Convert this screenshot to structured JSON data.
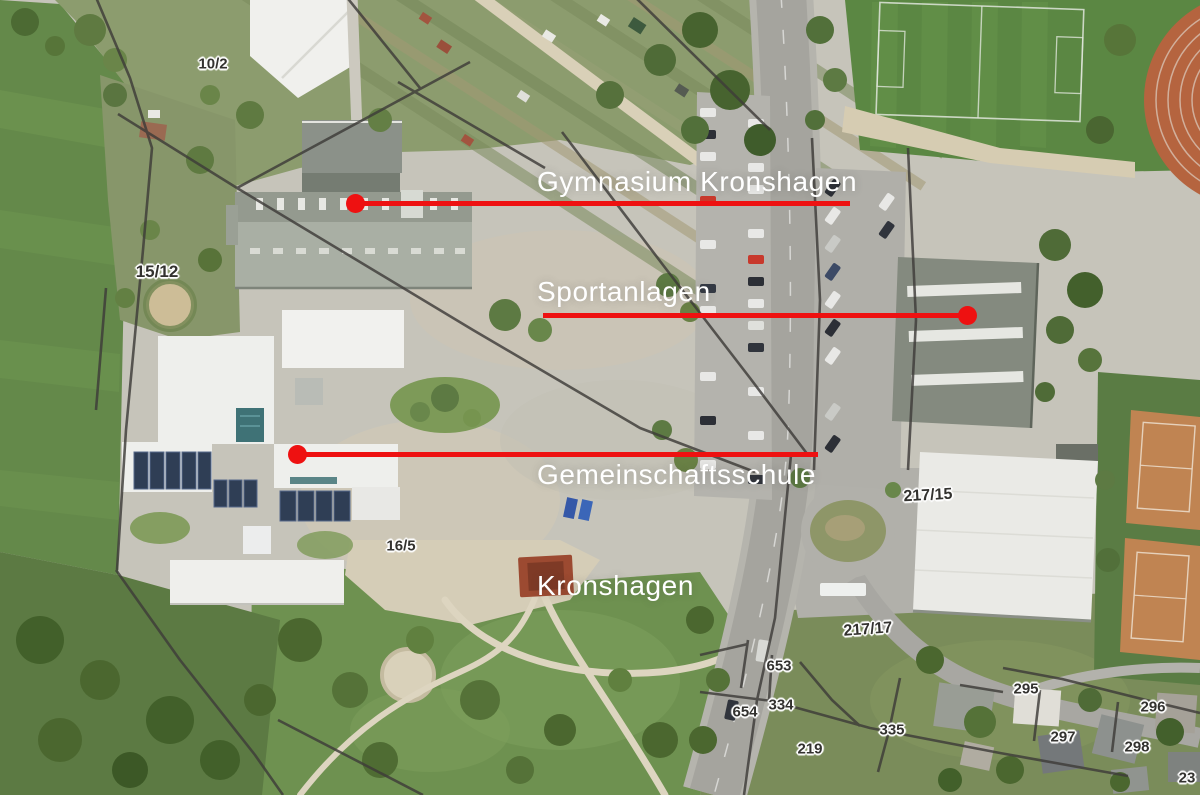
{
  "annotations": [
    {
      "id": "gymnasium",
      "label": "Gymnasium Kronshagen"
    },
    {
      "id": "sportanlagen",
      "label": "Sportanlagen"
    },
    {
      "id": "gemeinschaftsschule",
      "label": "Gemeinschaftsschule",
      "label2": "Kronshagen"
    }
  ],
  "parcels": [
    "10/2",
    "15/12",
    "16/5",
    "217/15",
    "217/17",
    "653",
    "654",
    "334",
    "335",
    "219",
    "295",
    "296",
    "297",
    "298",
    "23"
  ],
  "colors": {
    "annotation_line_red": "#ee1111",
    "annotation_text": "#ffffff",
    "parcel_text": "#33322f",
    "parcel_halo": "#ffffff"
  }
}
